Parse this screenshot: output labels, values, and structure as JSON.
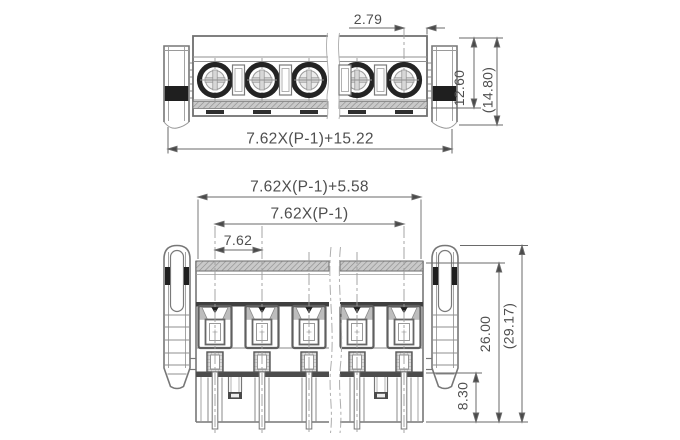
{
  "drawing_type": "terminal-block-connector-dimension-drawing",
  "colors": {
    "background": "#ffffff",
    "line": "#777777",
    "dark": "#1f1f1f",
    "dim_line": "#6a6a6a",
    "dim_text": "#4f4f4f"
  },
  "top_view": {
    "dims": {
      "screw_to_edge": "2.79",
      "body_height": "12.60",
      "overall_height_ref": "(14.80)",
      "overall_width_formula": "7.62X(P-1)+15.22"
    }
  },
  "front_view": {
    "dims": {
      "outer_width_formula": "7.62X(P-1)+5.58",
      "pole_span_formula": "7.62X(P-1)",
      "pitch": "7.62",
      "height_body": "26.00",
      "overall_height_ref": "(29.17)",
      "pin_length": "8.30"
    }
  }
}
